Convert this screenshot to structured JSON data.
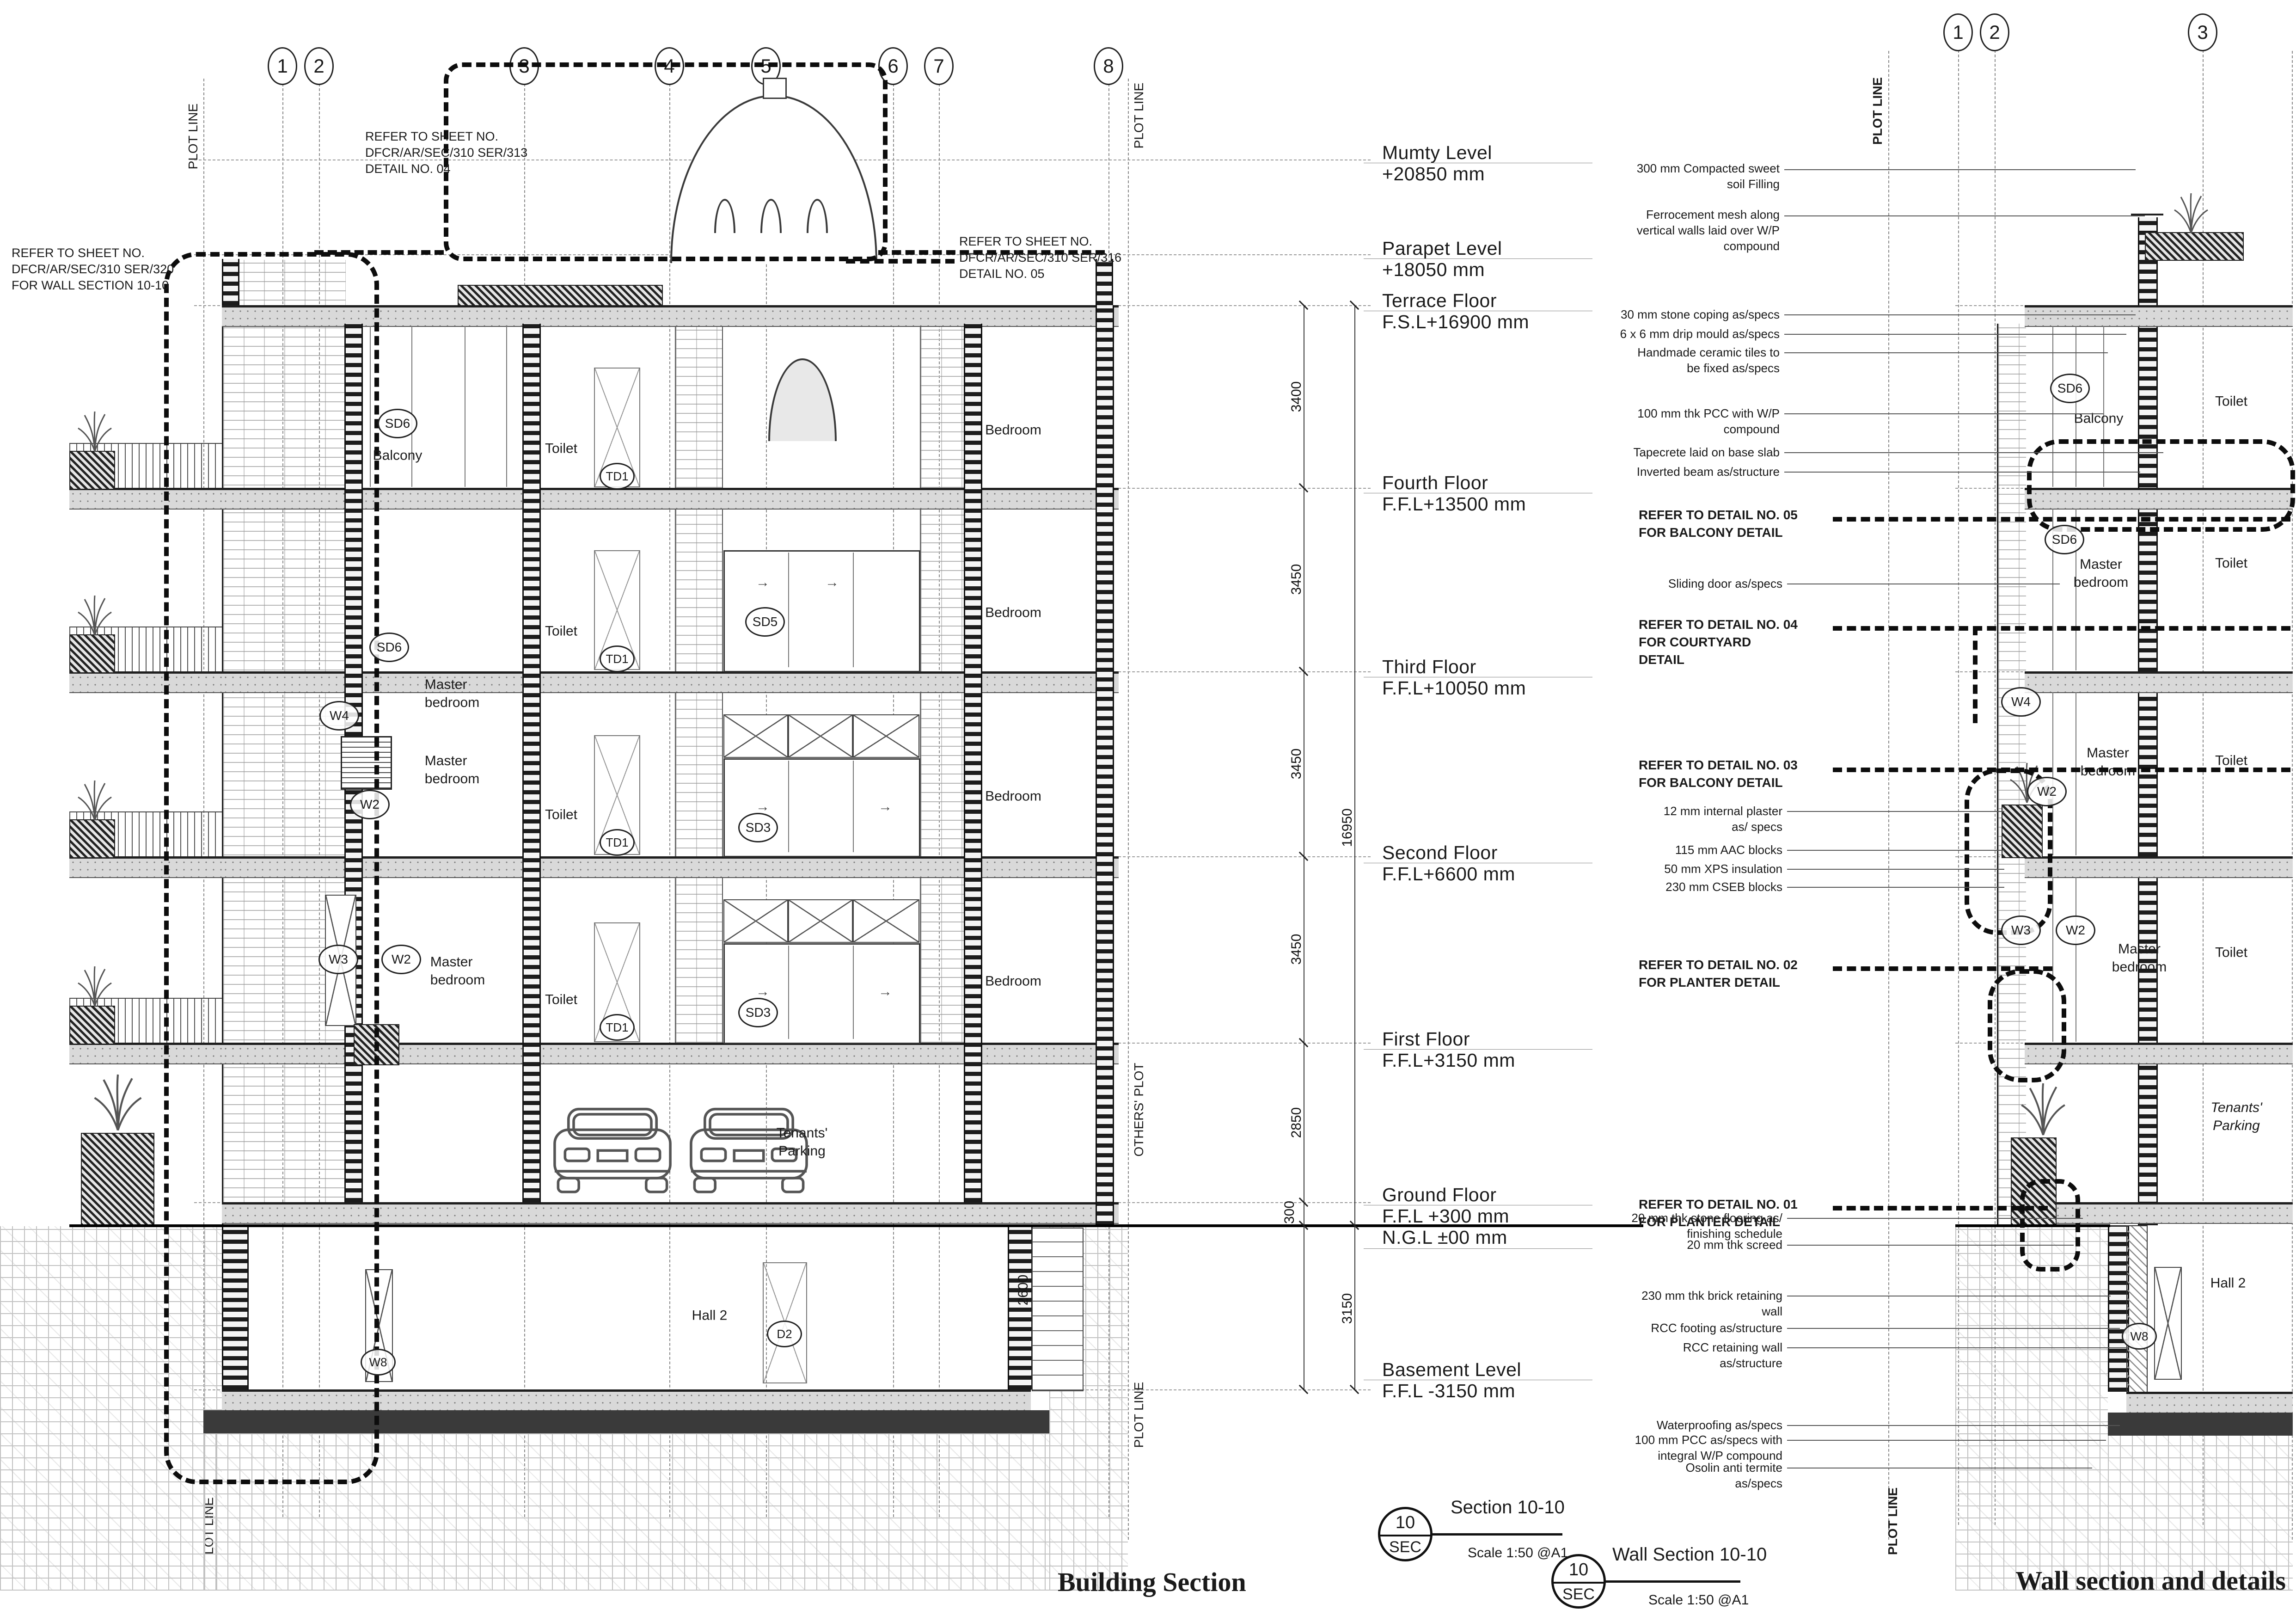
{
  "titles": {
    "left": "Building Section",
    "right": "Wall section and details"
  },
  "markers": [
    {
      "num": "10",
      "sub": "SEC",
      "title": "Section 10-10",
      "scale": "Scale 1:50 @A1"
    },
    {
      "num": "10",
      "sub": "SEC",
      "title": "Wall Section 10-10",
      "scale": "Scale 1:50 @A1"
    }
  ],
  "grids": {
    "left": [
      "1",
      "2",
      "3",
      "4",
      "5",
      "6",
      "7",
      "8"
    ],
    "right": [
      "1",
      "2",
      "3"
    ]
  },
  "levels": [
    {
      "name": "Mumty Level",
      "value": "+20850 mm"
    },
    {
      "name": "Parapet Level",
      "value": "+18050 mm"
    },
    {
      "name": "Terrace Floor",
      "value": "F.S.L+16900 mm"
    },
    {
      "name": "Fourth Floor",
      "value": "F.F.L+13500 mm"
    },
    {
      "name": "Third Floor",
      "value": "F.F.L+10050 mm"
    },
    {
      "name": "Second Floor",
      "value": "F.F.L+6600 mm"
    },
    {
      "name": "First Floor",
      "value": "F.F.L+3150 mm"
    },
    {
      "name": "Ground Floor",
      "value": "F.F.L +300 mm",
      "value2": "N.G.L ±00 mm"
    },
    {
      "name": "Basement Level",
      "value": "F.F.L -3150 mm"
    }
  ],
  "dims": {
    "segments": [
      "3400",
      "3450",
      "3450",
      "3450",
      "2850",
      "300",
      "3150"
    ],
    "overall": "16950",
    "shaft": "2600"
  },
  "refer_notes": {
    "detail04": "REFER TO SHEET NO.\nDFCR/AR/SEC/310 SER/313\nDETAIL NO. 04",
    "wallsec": "REFER TO SHEET NO.\nDFCR/AR/SEC/310 SER/320\nFOR WALL SECTION 10-10",
    "detail05": "REFER TO SHEET NO.\nDFCR/AR/SEC/310 SER/316\nDETAIL NO. 05"
  },
  "wall_annotations_top": [
    "300 mm Compacted sweet\nsoil Filling",
    "Ferrocement mesh along\nvertical walls laid over W/P\ncompound",
    "30 mm stone coping as/specs",
    "6 x 6 mm drip mould as/specs",
    "Handmade ceramic tiles to\nbe fixed as/specs",
    "100 mm thk PCC with W/P\ncompound",
    "Tapecrete laid on base slab",
    "Inverted beam as/structure"
  ],
  "detail_callouts": {
    "d05": "REFER TO DETAIL NO. 05\nFOR BALCONY DETAIL",
    "sliding": "Sliding door as/specs",
    "d04": "REFER TO DETAIL NO. 04\nFOR COURTYARD\nDETAIL",
    "d03": "REFER TO DETAIL NO. 03\nFOR BALCONY DETAIL",
    "plaster": "12 mm internal plaster\nas/ specs",
    "aac": "115 mm AAC blocks",
    "xps": "50 mm XPS insulation",
    "cseb": "230 mm CSEB blocks",
    "d02": "REFER TO DETAIL NO. 02\nFOR PLANTER DETAIL",
    "d01": "REFER TO DETAIL NO. 01\nFOR PLANTER DETAIL"
  },
  "wall_annotations_bottom": [
    "20 mm thk stone flooring as/\nfinishing schedule",
    "20 mm thk screed",
    "230 mm thk brick retaining\nwall",
    "RCC footing as/structure",
    "RCC retaining wall\nas/structure",
    "Waterproofing as/specs",
    "100 mm PCC as/specs with\nintegral W/P compound",
    "Osolin anti termite\nas/specs"
  ],
  "rooms": {
    "balcony": "Balcony",
    "toilet": "Toilet",
    "bedroom": "Bedroom",
    "master": "Master\nbedroom",
    "tenants": "Tenants'\nParking",
    "hall2": "Hall 2"
  },
  "tags": {
    "sd6": "SD6",
    "sd5": "SD5",
    "sd3": "SD3",
    "td1": "TD1",
    "w4": "W4",
    "w3": "W3",
    "w2": "W2",
    "w8": "W8",
    "d2": "D2"
  },
  "boundary": {
    "plot_line": "PLOT LINE",
    "lot_line": "LOT LINE",
    "others_plot": "OTHERS' PLOT"
  }
}
